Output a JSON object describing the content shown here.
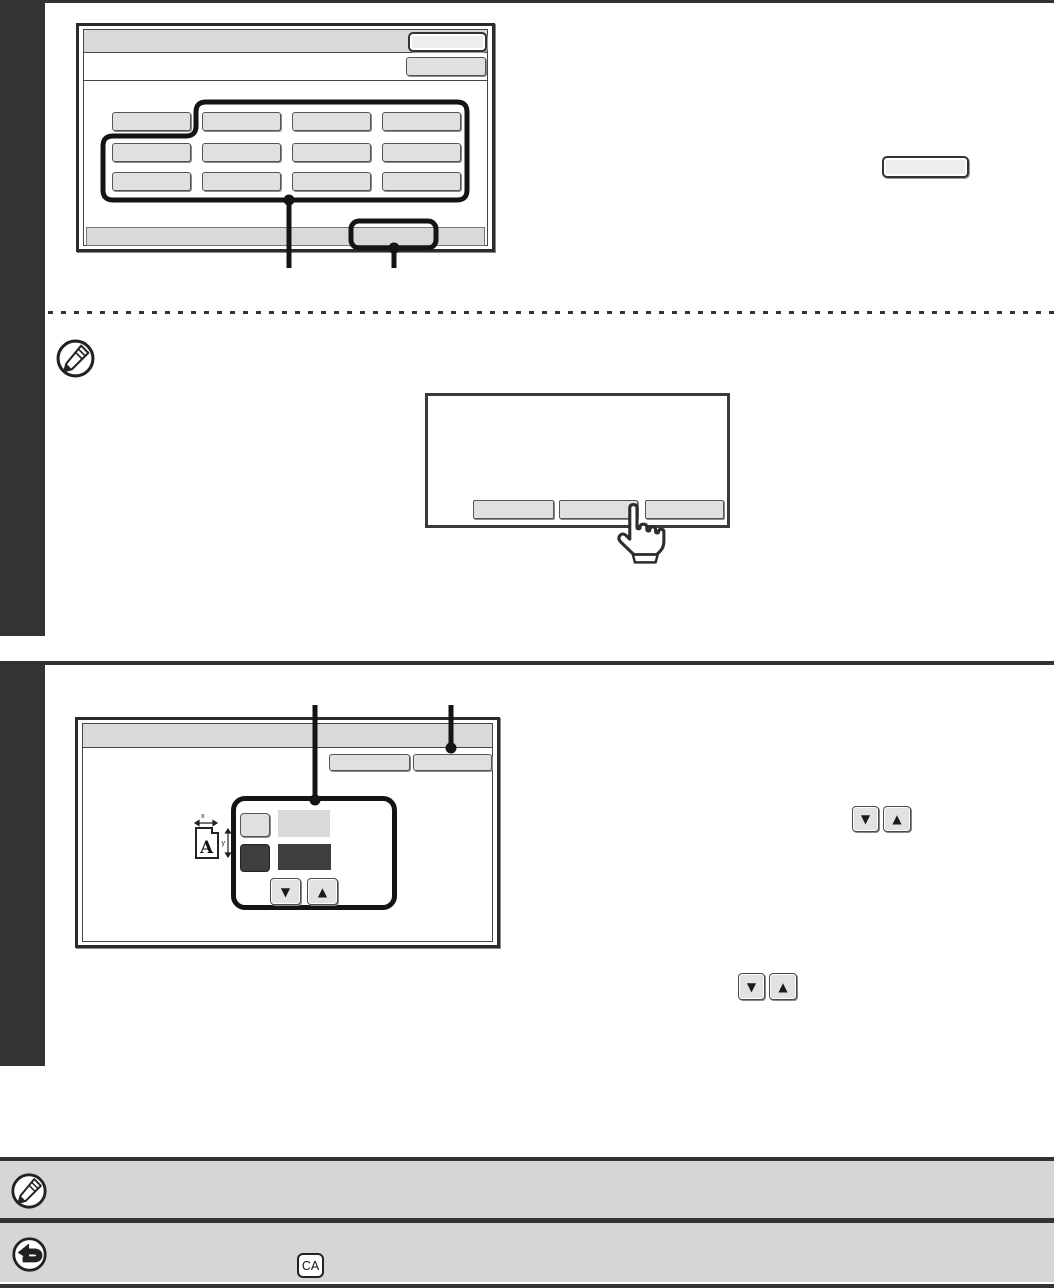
{
  "colors": {
    "chrome_dark": "#333333",
    "band_gray": "#d6d6d6",
    "screen_gray": "#d9d9d9",
    "key_gray": "#e0e0e0",
    "dark_key": "#3e3e3e",
    "callout_black": "#141414"
  },
  "glyphs": {
    "down_arrow": "▼",
    "up_arrow": "▲"
  },
  "screen1": {
    "title": "",
    "title_button": "",
    "sub_button": "",
    "grid_buttons": [
      "",
      "",
      "",
      "",
      "",
      "",
      "",
      "",
      "",
      "",
      "",
      ""
    ],
    "bottom_bar": "",
    "callout_button": ""
  },
  "inline_key": {
    "label": ""
  },
  "note1": {
    "icon": "pencil-circle-icon",
    "text": ""
  },
  "dialog": {
    "message": "",
    "buttons": [
      "",
      "",
      ""
    ],
    "pointer_icon": "hand-touch-icon"
  },
  "screen2": {
    "title": "",
    "button_a": "",
    "button_b": "",
    "xy_icon": {
      "letter": "A",
      "x_label": "x",
      "y_label": "y"
    },
    "x_key": "",
    "x_value": "",
    "y_key": "",
    "y_value": ""
  },
  "footer": {
    "note_icon": "pencil-circle-icon",
    "back_icon": "return-arrow-icon",
    "ca_key": "CA"
  }
}
